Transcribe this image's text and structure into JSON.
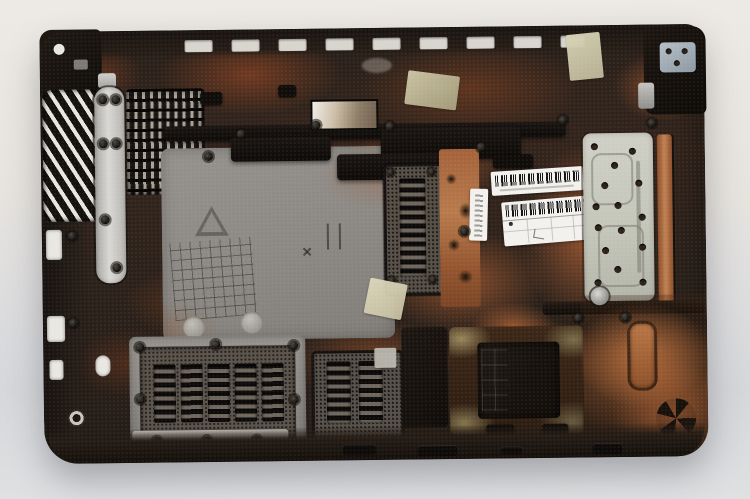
{
  "scene": {
    "description": "Photograph of a disassembled laptop bottom case shown from the inner side, lying on a light studio surface. The dark plastic chassis is heavily stained with copper-brown heat discoloration and carries cooling vents, mesh grilles, metal shield plates, hinge mounts, screws, masking-tape remnants and service barcode stickers.",
    "object": "laptop-bottom-case",
    "orientation": "inner side up, hinge edge at top",
    "visible_text_legible": false
  },
  "colors": {
    "background_top": "#edeae5",
    "background_bottom": "#d5d7da",
    "case_black": "#221b16",
    "case_brown": "#48291a",
    "copper": "#a4613a",
    "copper_light": "#c08253",
    "gray_panel": "#8e8b86",
    "silver": "#c9c8c4",
    "plate_silver": "#c8cabd",
    "mesh_dark": "#36322d",
    "label_white": "#f3f1ed",
    "tape_khaki": "#c2b992",
    "recess_black": "#17120e"
  },
  "stickers": {
    "barcode_label_top": {
      "kind": "white barcode sticker",
      "legible": false
    },
    "barcode_label_bottom": {
      "kind": "white barcode sticker with printed table and handwritten mark",
      "legible": false
    },
    "vertical_label": {
      "kind": "small vertical serial sticker",
      "legible": false
    }
  },
  "parts": {
    "left_exhaust_vent": "angled exhaust vent slots on left edge",
    "left_shield_bracket": "screwed silver bracket plate",
    "cpu_vent_grid": "louvered intake grid, upper left",
    "center_molded_panel": "gray molded panel with recycling triangle, molded grid and bosses",
    "center_mesh_vent": "vertical meshed louver vent, center",
    "right_shield_plate": "perforated silver shield plate with stamped channel",
    "bottom_left_vent": "large meshed vent with five louver columns",
    "bottom_center_vent": "small meshed vent with two louver columns",
    "battery_bay": "dark recessed bay, lower right",
    "hinge_mount_left": "left hinge mount lug",
    "hinge_mount_right": "right hinge mount with bracket and metal fitting",
    "tape_pieces": "four pieces of masking tape / residue",
    "screws": "numerous black screws and screw bosses"
  }
}
